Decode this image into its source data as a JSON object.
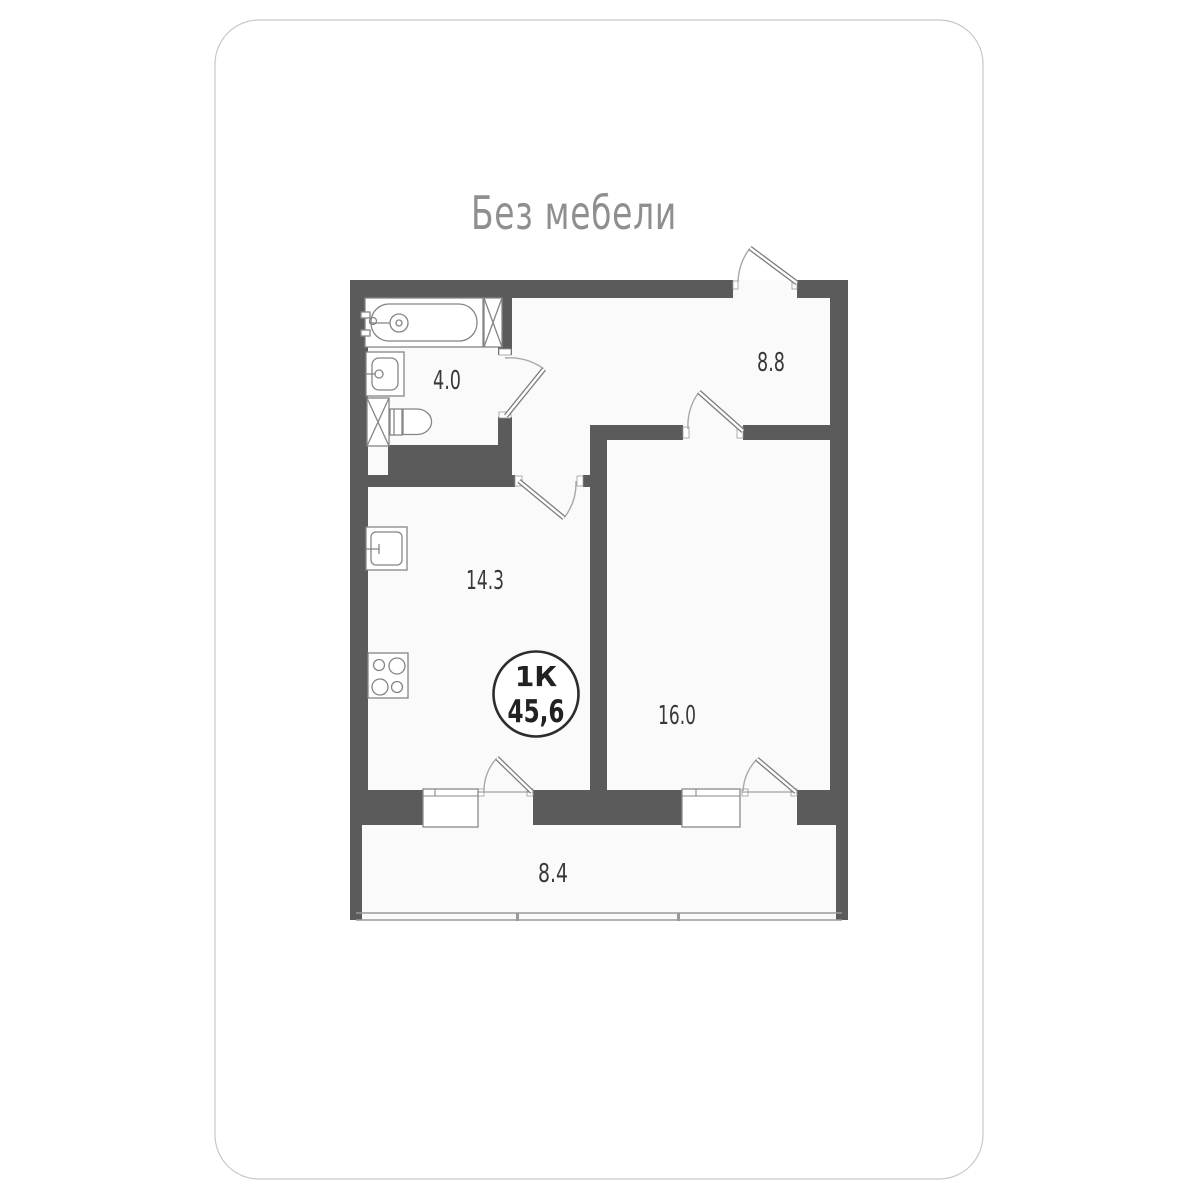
{
  "card": {
    "title": "Без мебели"
  },
  "plan": {
    "badge": {
      "rooms_type": "1К",
      "total_area": "45,6"
    },
    "rooms": [
      {
        "name": "bathroom",
        "area": "4.0"
      },
      {
        "name": "hallway",
        "area": "8.8"
      },
      {
        "name": "kitchen",
        "area": "14.3"
      },
      {
        "name": "living-room",
        "area": "16.0"
      },
      {
        "name": "balcony",
        "area": "8.4"
      }
    ]
  },
  "colors": {
    "wall": "#5b5b5b",
    "floor": "#fafafa",
    "card_background": "#ffffff",
    "card_border": "#c7c7c7",
    "label_text": "#383838",
    "title_text": "#8f8f8f",
    "badge_border": "#2d2d2d"
  }
}
